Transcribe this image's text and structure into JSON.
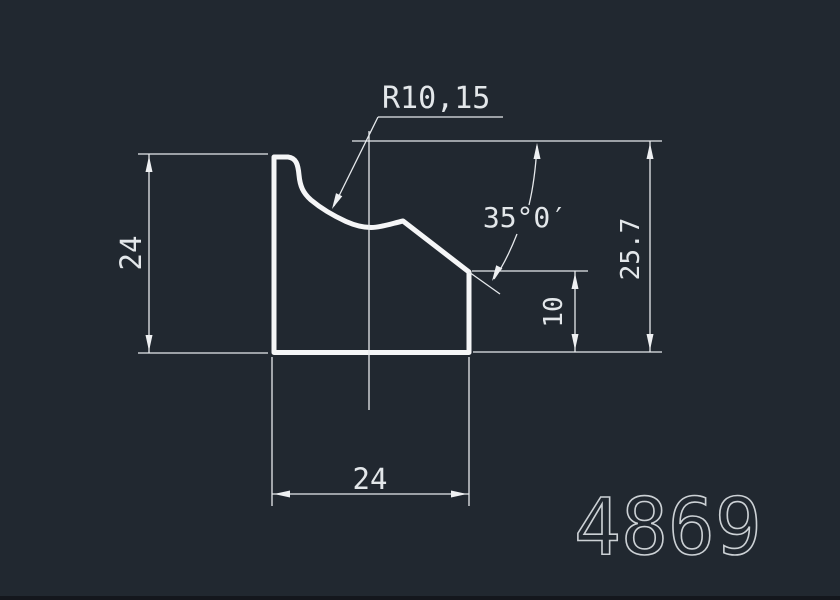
{
  "canvas": {
    "background_color": "#212830",
    "profile_line_color": "#f5f6f7",
    "dimension_line_color": "#e6e9ec",
    "text_color": "#e3e7ea",
    "part_number_color": "#ccd1d5",
    "bottom_strip_color": "#14171d"
  },
  "drawing": {
    "radius_label": "R10,15",
    "angle_label": "35°0′",
    "dim_left_height": "24",
    "dim_right_height": "25.7",
    "dim_step_height": "10",
    "dim_bottom_width": "24",
    "part_number": "4869"
  }
}
